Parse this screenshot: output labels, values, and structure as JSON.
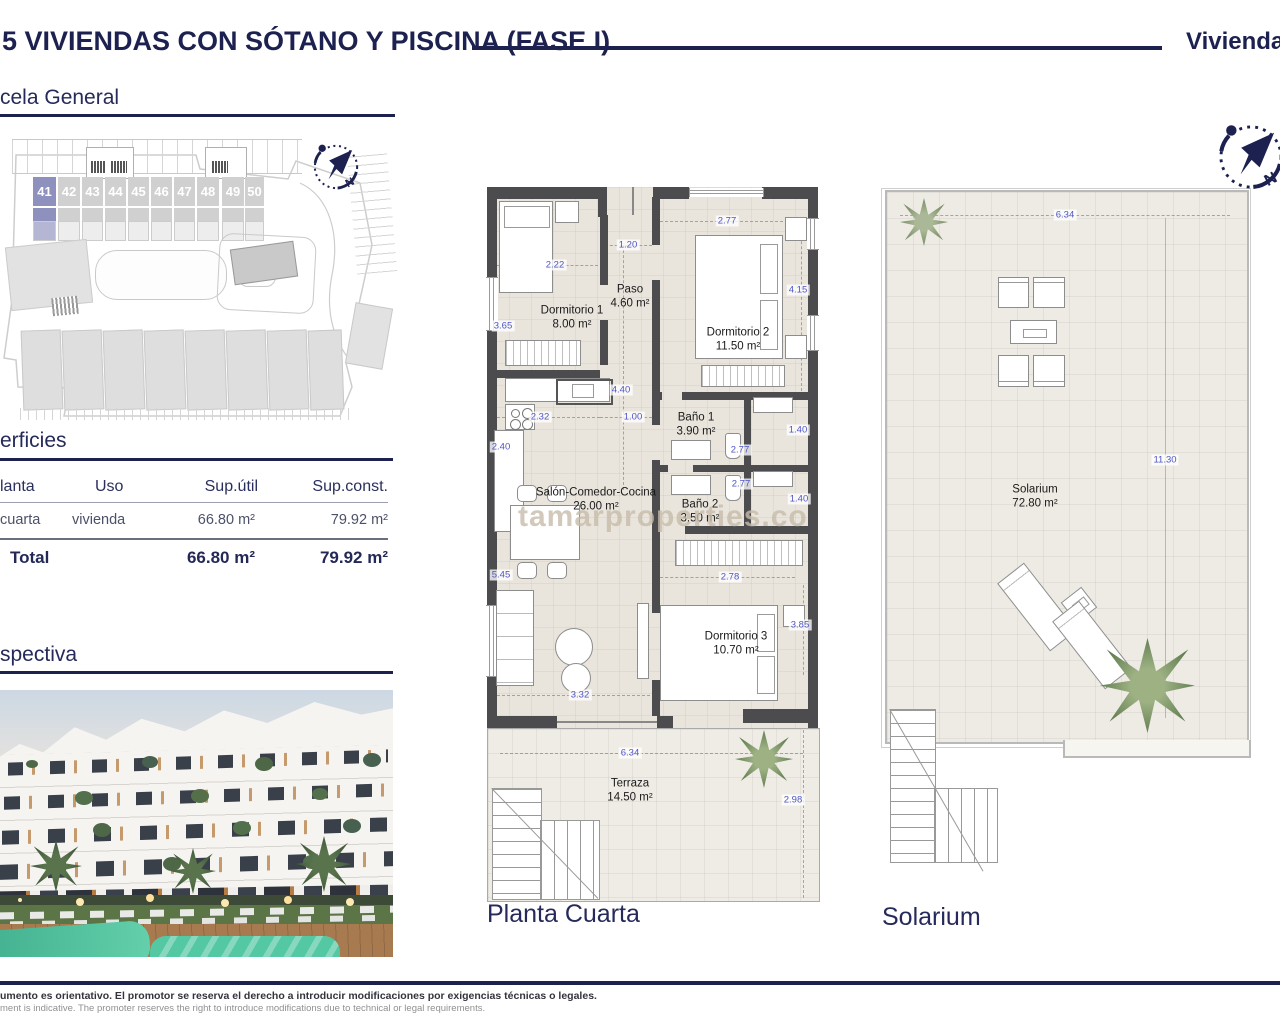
{
  "header": {
    "title": "5 VIVIENDAS CON SÓTANO Y PISCINA (FASE I)",
    "right_label": "Viviendas"
  },
  "sections": {
    "parcela_title": "cela General",
    "superficies_title": "erficies",
    "perspectiva_title": "spectiva"
  },
  "site_plan": {
    "plots": [
      "41",
      "42",
      "43",
      "44",
      "45",
      "46",
      "47",
      "48",
      "49",
      "50"
    ],
    "highlighted_plot": "41"
  },
  "superficies_table": {
    "col_planta": "lanta",
    "col_uso": "Uso",
    "col_sup_util": "Sup.útil",
    "col_sup_const": "Sup.const.",
    "row": {
      "planta": "cuarta",
      "uso": "vivienda",
      "sup_util": "66.80 m²",
      "sup_const": "79.92 m²"
    },
    "total": {
      "label": "Total",
      "sup_util": "66.80 m²",
      "sup_const": "79.92 m²"
    }
  },
  "floor_plan": {
    "caption": "Planta Cuarta",
    "rooms": {
      "dorm1": {
        "name": "Dormitorio 1",
        "area": "8.00 m²"
      },
      "paso": {
        "name": "Paso",
        "area": "4.60 m²"
      },
      "dorm2": {
        "name": "Dormitorio 2",
        "area": "11.50 m²"
      },
      "bano1": {
        "name": "Baño 1",
        "area": "3.90 m²"
      },
      "bano2": {
        "name": "Baño 2",
        "area": "3.50 m²"
      },
      "salon": {
        "name": "Salón-Comedor-Cocina",
        "area": "26.00 m²"
      },
      "dorm3": {
        "name": "Dormitorio 3",
        "area": "10.70 m²"
      },
      "terraza": {
        "name": "Terraza",
        "area": "14.50 m²"
      }
    },
    "dims": {
      "w365": "3.65",
      "w222": "2.22",
      "w120": "1.20",
      "w440": "4.40",
      "w277a": "2.77",
      "w415": "4.15",
      "w232": "2.32",
      "w100": "1.00",
      "w240": "2.40",
      "w277b": "2.77",
      "w140a": "1.40",
      "w277c": "2.77",
      "w140b": "1.40",
      "w545": "5.45",
      "w278": "2.78",
      "w385": "3.85",
      "w332": "3.32",
      "w634": "6.34",
      "w298": "2.98"
    }
  },
  "solarium_plan": {
    "caption": "Solarium",
    "room": {
      "name": "Solarium",
      "area": "72.80 m²"
    },
    "dims": {
      "w634": "6.34",
      "w1130": "11.30"
    }
  },
  "compass": {
    "north_label": "N"
  },
  "watermark": "tamarproperties.co",
  "footer": {
    "line_es": "umento es orientativo. El promotor se reserva el derecho a introducir modificaciones por exigencias técnicas o legales.",
    "line_en": "ment is indicative. The promoter reserves the right to introduce modifications due to technical or legal requirements."
  },
  "colors": {
    "navy": "#1c2150",
    "dim_blue": "#4d55c4",
    "wall": "#4c4c4f",
    "plot_highlight": "#8e90bd"
  }
}
